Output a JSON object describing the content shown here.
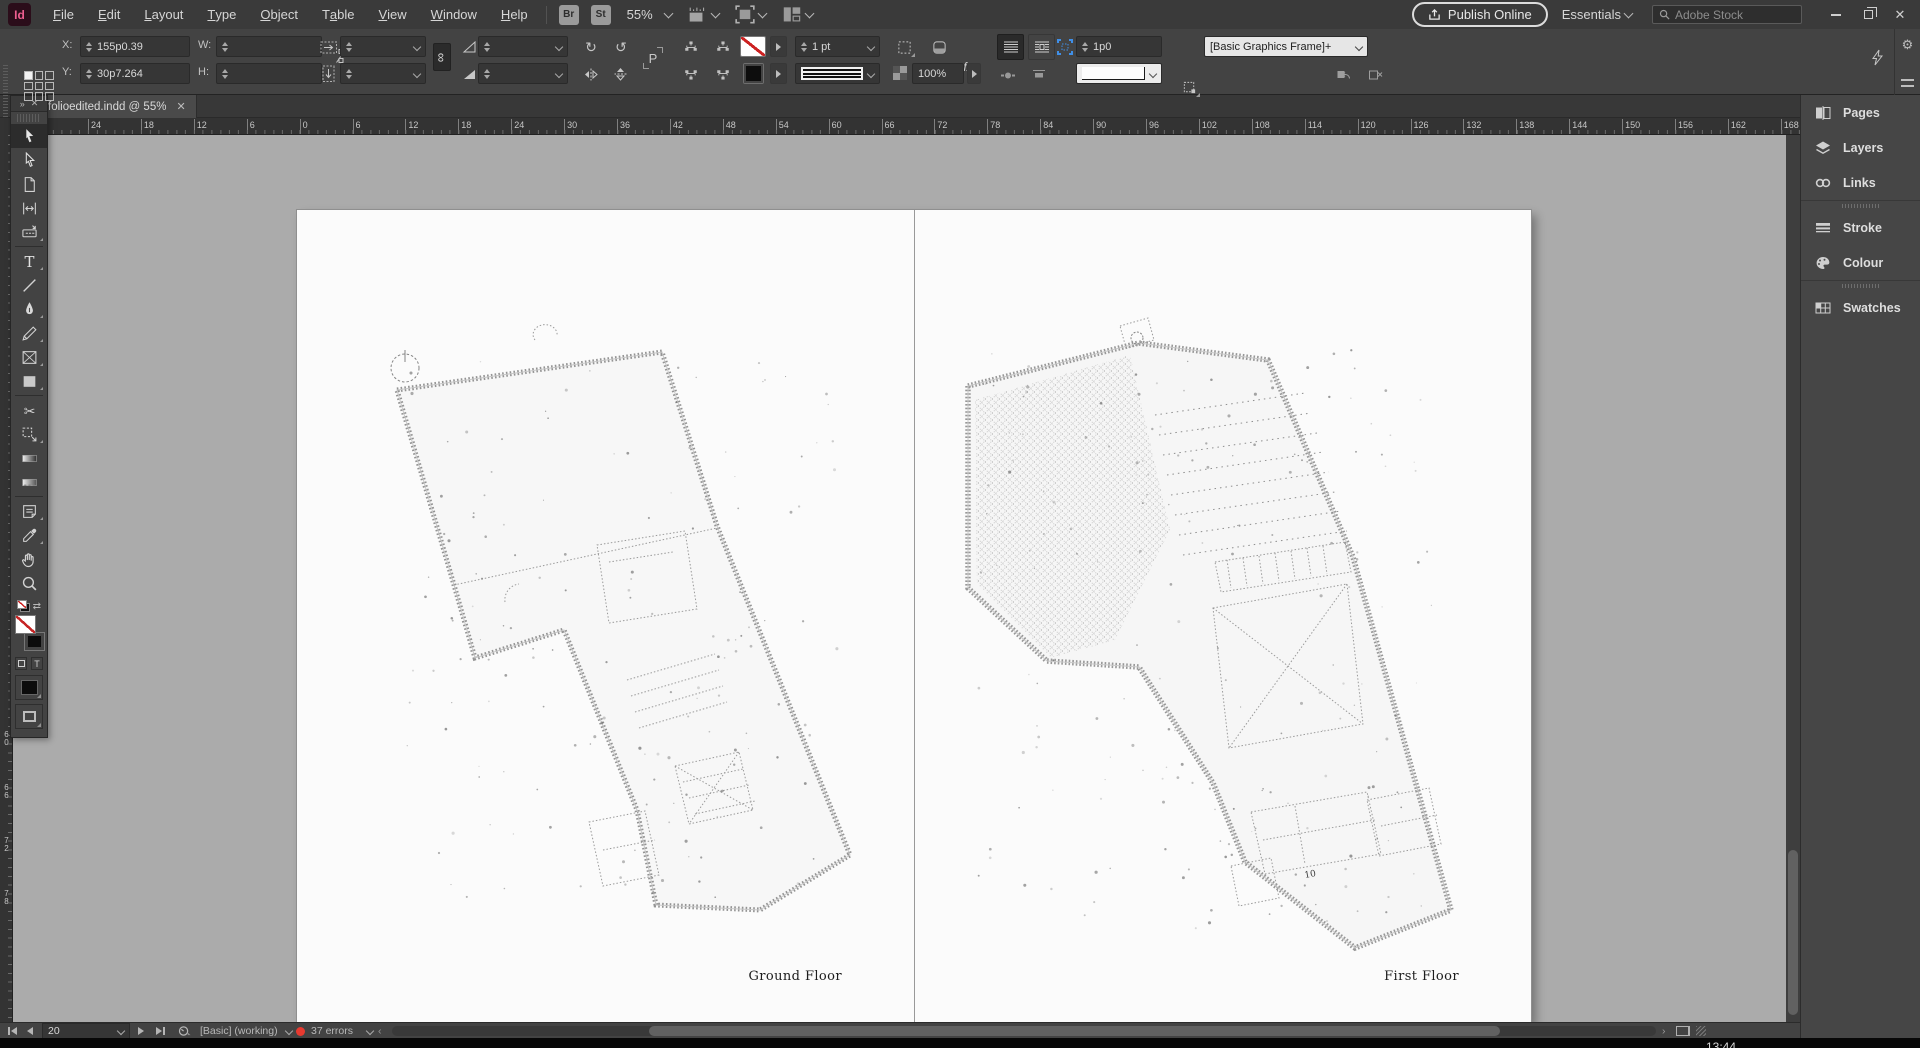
{
  "menubar": {
    "logo": "Id",
    "menus": [
      {
        "label": "File",
        "accel": "F"
      },
      {
        "label": "Edit",
        "accel": "E"
      },
      {
        "label": "Layout",
        "accel": "L"
      },
      {
        "label": "Type",
        "accel": "T"
      },
      {
        "label": "Object",
        "accel": "O"
      },
      {
        "label": "Table",
        "accel": "a"
      },
      {
        "label": "View",
        "accel": "V"
      },
      {
        "label": "Window",
        "accel": "W"
      },
      {
        "label": "Help",
        "accel": "H"
      }
    ],
    "bridge_button": "Br",
    "stock_button": "St",
    "zoom_level": "55%",
    "publish_button": "Publish Online",
    "workspace_switcher": "Essentials",
    "stock_search_placeholder": "Adobe Stock"
  },
  "control_panel": {
    "x_label": "X:",
    "x_value": "155p0.39",
    "y_label": "Y:",
    "y_value": "30p7.264",
    "w_label": "W:",
    "w_value": "",
    "h_label": "H:",
    "h_value": "",
    "stroke_weight": "1 pt",
    "effects_label": "fx",
    "opacity_value": "100%",
    "gap_value": "1p0",
    "object_style": "[Basic Graphics Frame]+"
  },
  "document_tab": {
    "title": "folioedited.indd @ 55%"
  },
  "rulers": {
    "horizontal_ticks": [
      "24",
      "18",
      "12",
      "6",
      "0",
      "6",
      "12",
      "18",
      "24",
      "30",
      "36",
      "42",
      "48",
      "54",
      "60",
      "66",
      "72",
      "78",
      "84",
      "90",
      "96",
      "102",
      "108",
      "114",
      "120",
      "126",
      "132",
      "138",
      "144",
      "150",
      "156",
      "162",
      "168"
    ],
    "vertical_ticks": [
      "60",
      "66",
      "72",
      "78"
    ]
  },
  "tools": [
    {
      "name": "selection-tool",
      "active": true
    },
    {
      "name": "direct-selection-tool"
    },
    {
      "name": "page-tool"
    },
    {
      "name": "gap-tool"
    },
    {
      "name": "content-collector-tool"
    },
    {
      "name": "type-tool"
    },
    {
      "name": "line-tool"
    },
    {
      "name": "pen-tool"
    },
    {
      "name": "pencil-tool"
    },
    {
      "name": "rectangle-frame-tool"
    },
    {
      "name": "rectangle-tool"
    },
    {
      "name": "scissors-tool"
    },
    {
      "name": "free-transform-tool"
    },
    {
      "name": "gradient-swatch-tool"
    },
    {
      "name": "gradient-feather-tool"
    },
    {
      "name": "note-tool"
    },
    {
      "name": "eyedropper-tool"
    },
    {
      "name": "hand-tool"
    },
    {
      "name": "zoom-tool"
    }
  ],
  "panel_dock": {
    "groups": [
      [
        {
          "icon": "pages-icon",
          "label": "Pages"
        },
        {
          "icon": "layers-icon",
          "label": "Layers"
        },
        {
          "icon": "links-icon",
          "label": "Links"
        }
      ],
      [
        {
          "icon": "stroke-icon",
          "label": "Stroke"
        },
        {
          "icon": "colour-icon",
          "label": "Colour"
        }
      ],
      [
        {
          "icon": "swatches-icon",
          "label": "Swatches"
        }
      ]
    ]
  },
  "spread": {
    "left_page_label": "Ground Floor",
    "right_page_label": "First Floor",
    "plan_annotation": "10"
  },
  "status_bar": {
    "page_number": "20",
    "preset": "[Basic] (working)",
    "error_count": "37 errors"
  },
  "taskbar": {
    "clock": "13:44"
  },
  "colors": {
    "accent_blue": "#3f8fe8",
    "error_red": "#e83a30",
    "logo_pink": "#ee5e90",
    "none_slash_red": "#cc2222"
  }
}
